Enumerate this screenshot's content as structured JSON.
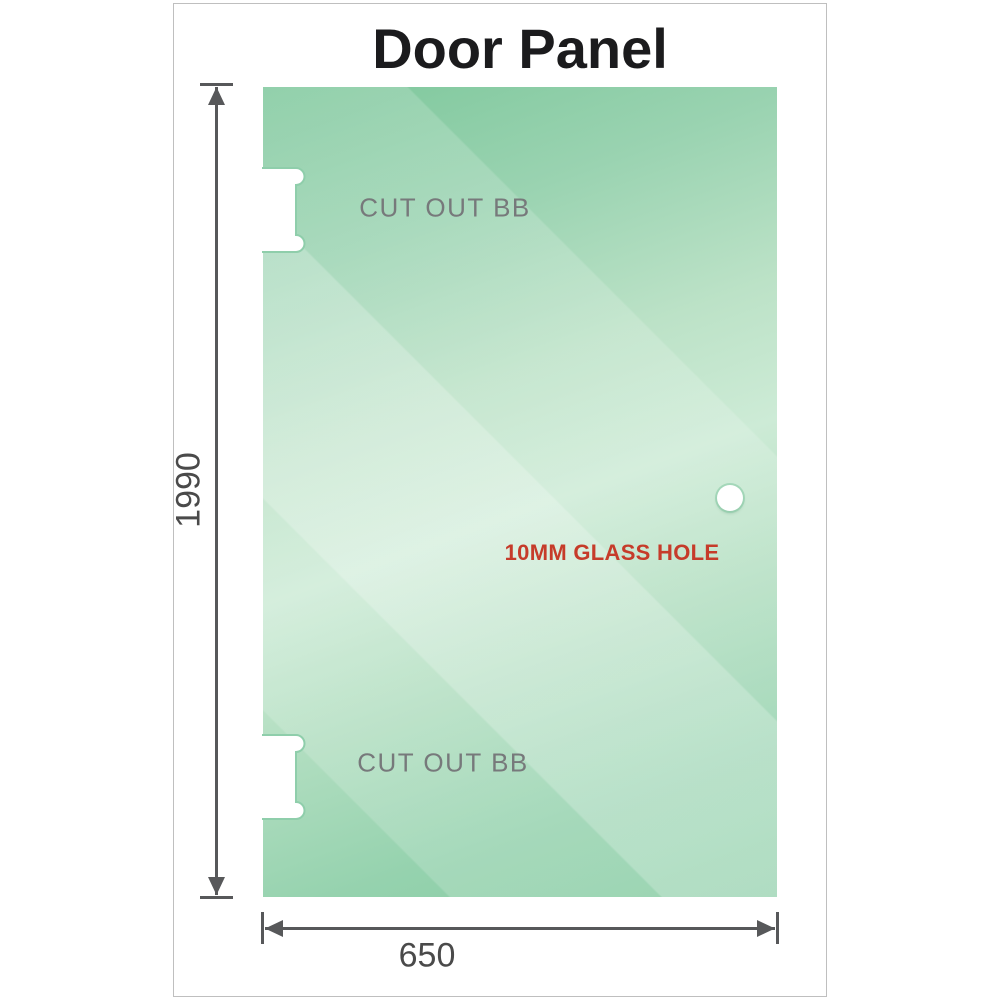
{
  "title": "Door Panel",
  "glass_panel": {
    "hole_label": "10MM GLASS HOLE"
  },
  "cutouts": [
    {
      "label": "CUT OUT BB"
    },
    {
      "label": "CUT OUT BB"
    }
  ],
  "dimensions": {
    "height_value": "1990",
    "width_value": "650"
  },
  "colors": {
    "glass_dark": "#7dc79b",
    "glass_light": "#cdebd6",
    "dim_color": "#57585a",
    "dim_text": "#4a4a4a",
    "hole_text": "#c63b2a",
    "cutout_text": "#77797b",
    "title_text": "#1b1b1d",
    "frame_border": "#bfbfbf",
    "cutout_stroke": "#8fceab"
  }
}
